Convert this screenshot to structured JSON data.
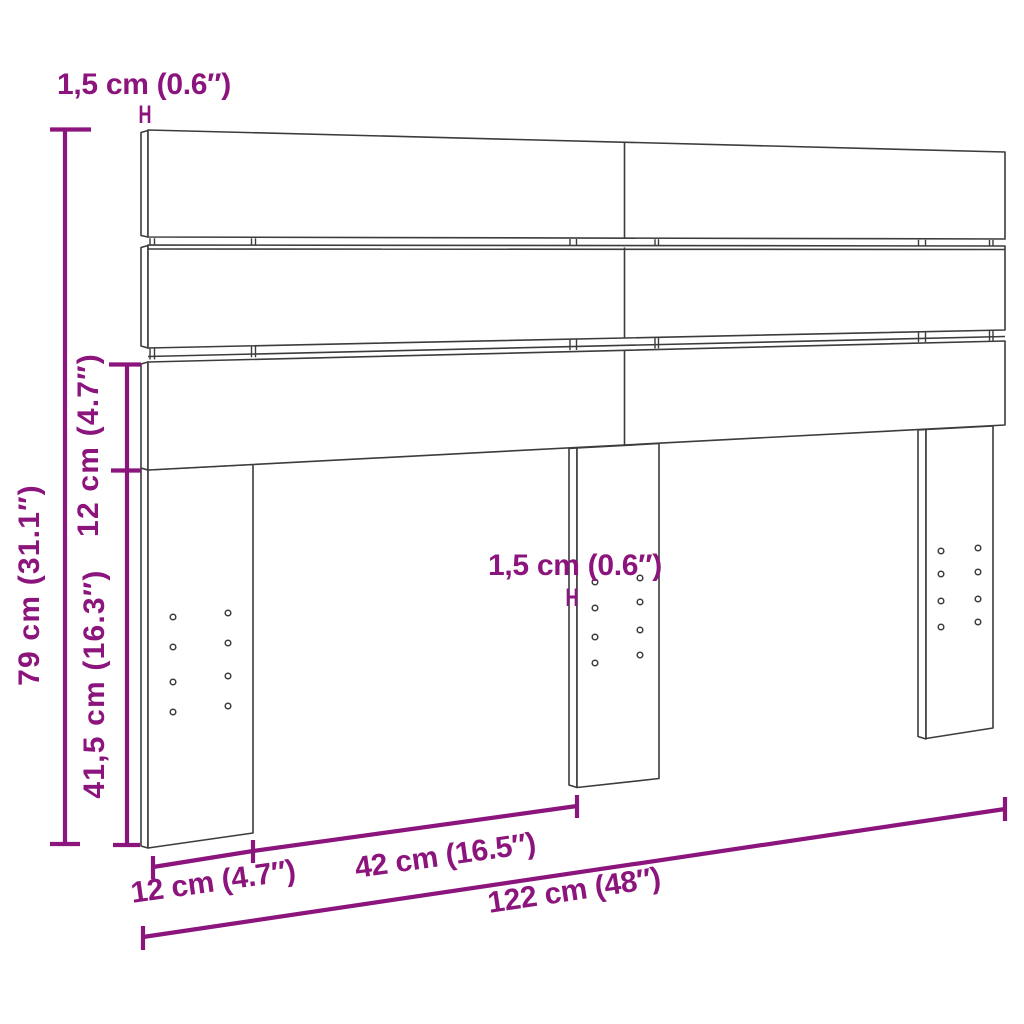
{
  "diagram": {
    "colors": {
      "dimension_accent": "#8c147d",
      "drawing_outline": "#3c3c3c",
      "background": "#ffffff"
    },
    "thickness_marker": "H",
    "dims": {
      "top_thickness": "1,5 cm (0.6″)",
      "mid_thickness": "1,5 cm (0.6″)",
      "total_height": "79 cm (31.1″)",
      "panel_height": "12 cm (4.7″)",
      "leg_height": "41,5 cm (16.3″)",
      "leg_width": "12 cm (4.7″)",
      "leg_spacing": "42 cm (16.5″)",
      "total_width": "122 cm (48″)"
    }
  }
}
